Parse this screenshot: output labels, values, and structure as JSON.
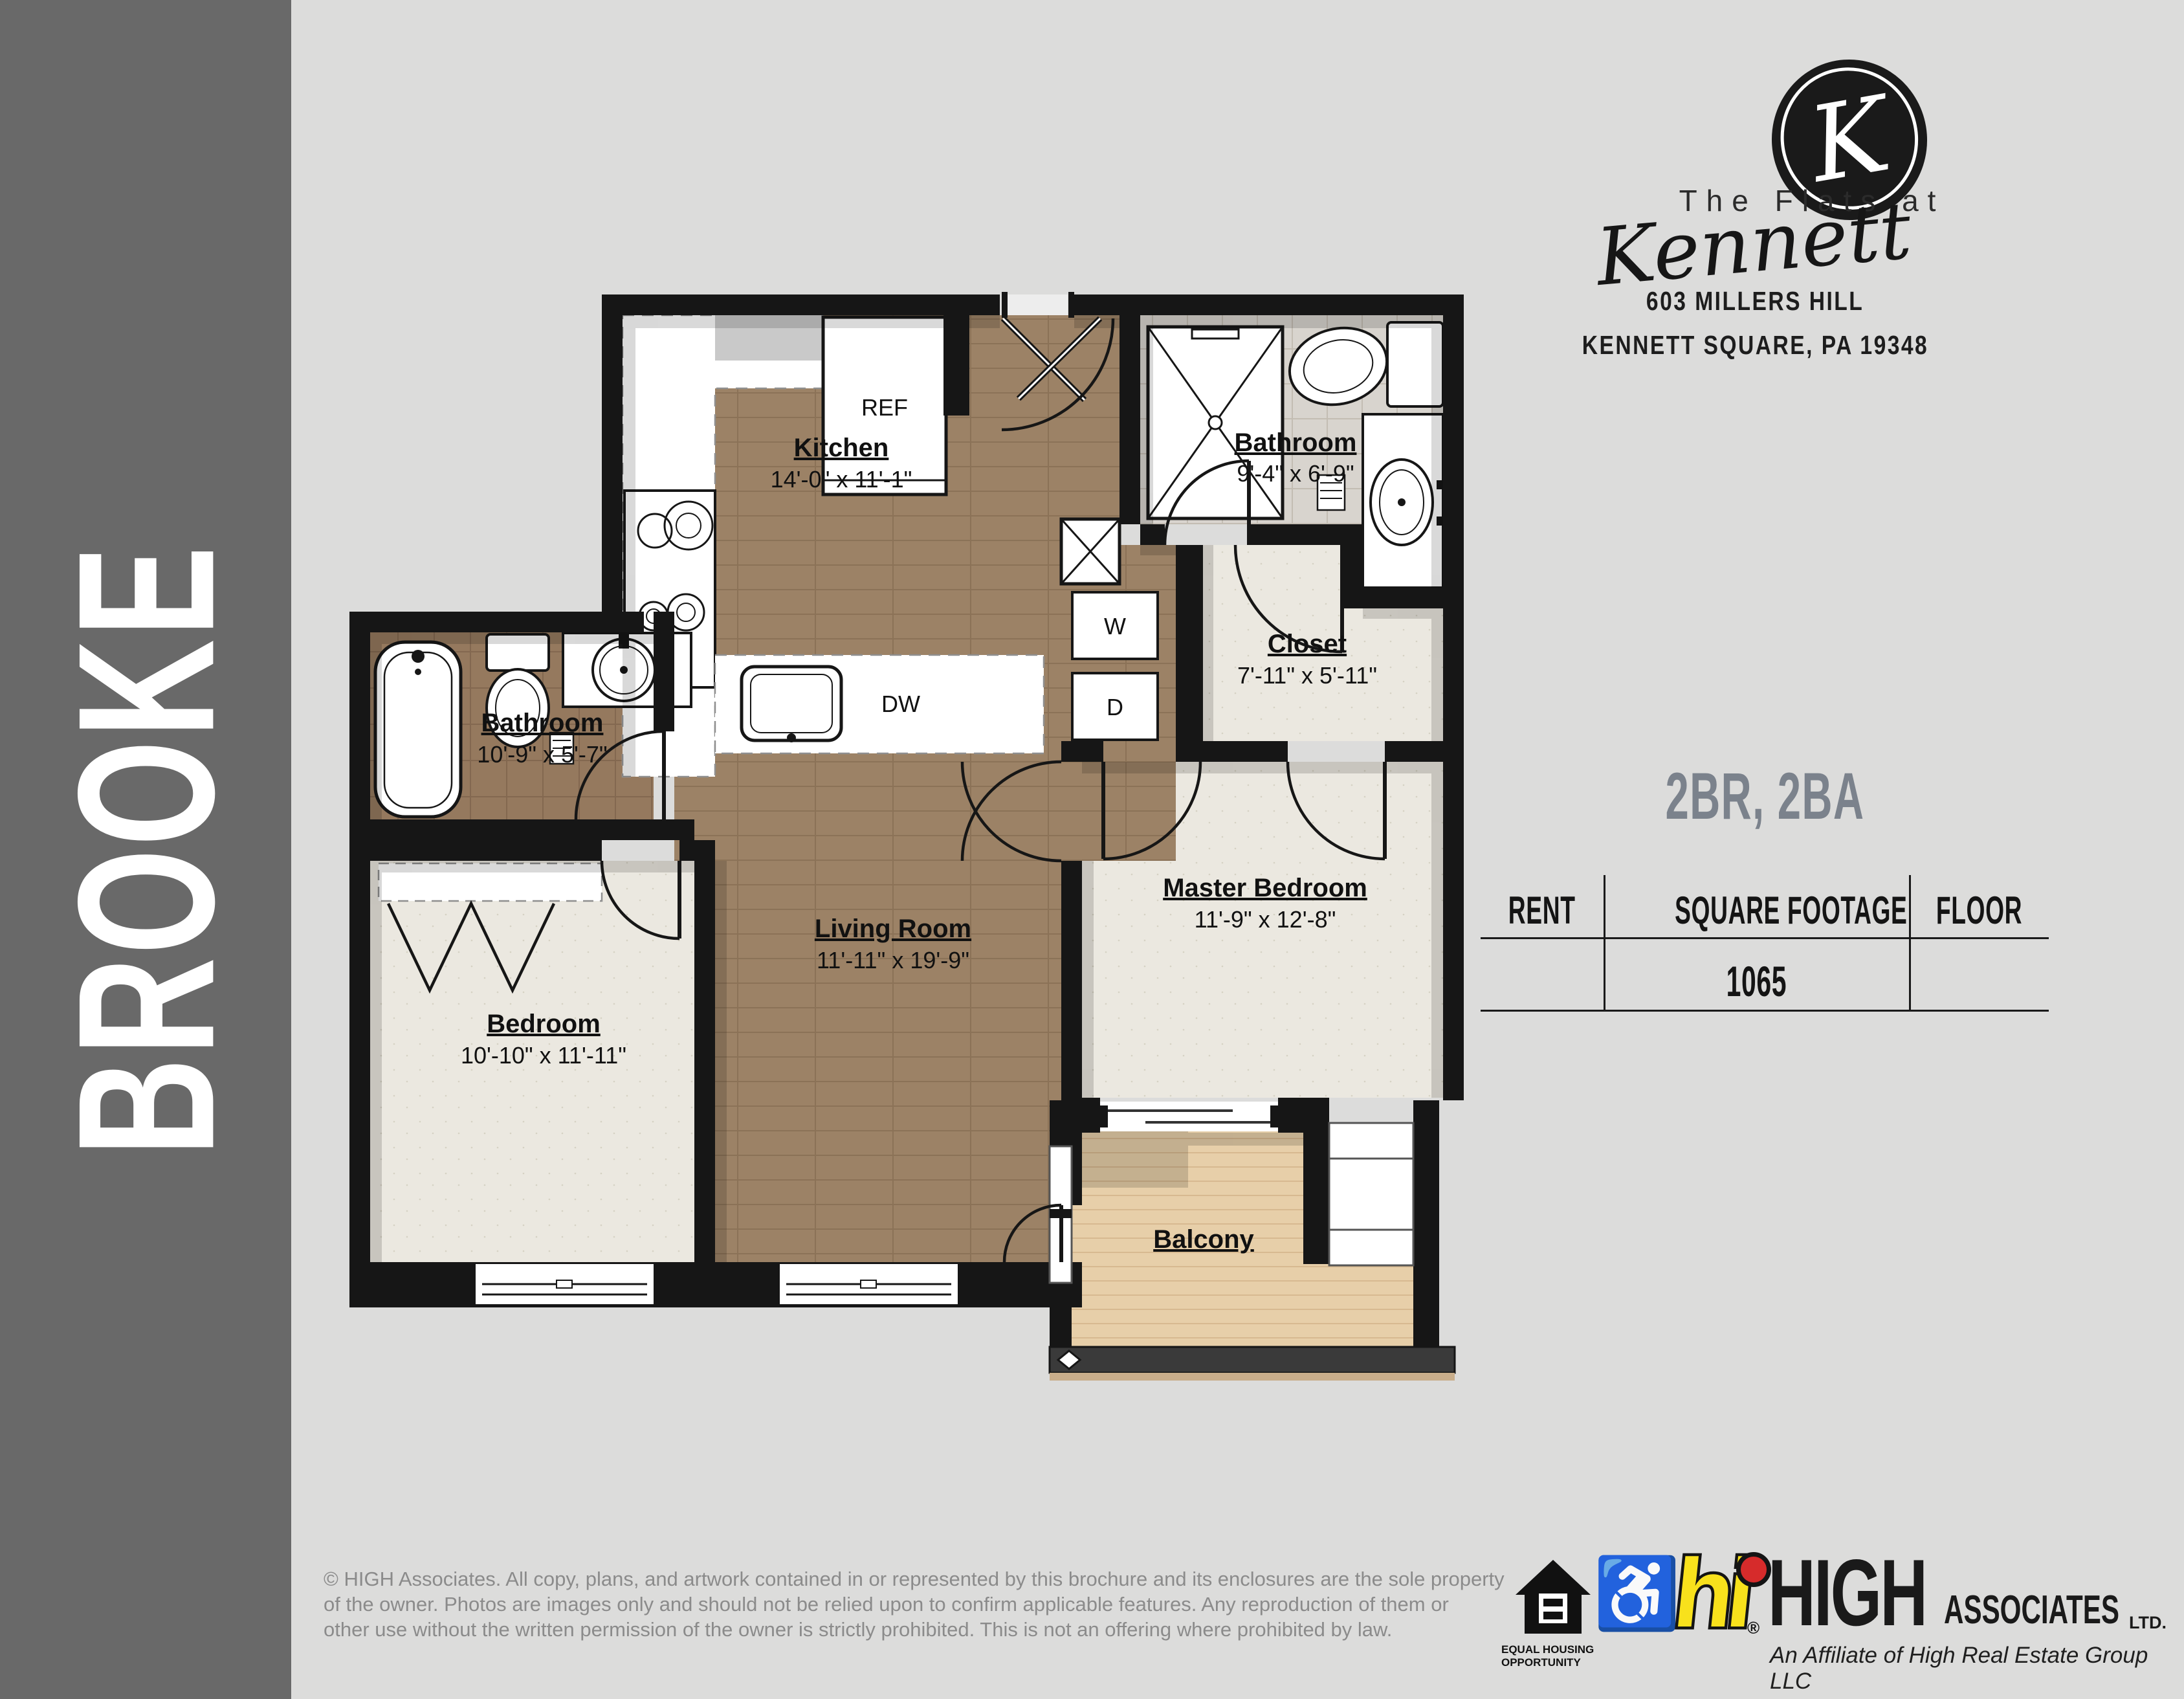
{
  "sidebar": {
    "label": "BROOKE"
  },
  "brand": {
    "monogram": "K",
    "line1": "The Flats at",
    "script": "Kennett",
    "address1": "603 MILLERS HILL",
    "address2": "KENNETT SQUARE, PA 19348"
  },
  "unit": {
    "title": "2BR, 2BA",
    "title_color": "#7b828c",
    "table": {
      "headers": [
        "RENT",
        "SQUARE FOOTAGE",
        "FLOOR"
      ],
      "rent": "",
      "square_footage": "1065",
      "floor": ""
    }
  },
  "floorplan": {
    "rooms": {
      "kitchen": {
        "name": "Kitchen",
        "dims": "14'-0\" x 11'-1\""
      },
      "bath2": {
        "name": "Bathroom",
        "dims": "9'-4\" x 6'-9\""
      },
      "closet": {
        "name": "Closet",
        "dims": "7'-11\" x 5'-11\""
      },
      "bath1": {
        "name": "Bathroom",
        "dims": "10'-9\" x 5'-7\""
      },
      "bedroom": {
        "name": "Bedroom",
        "dims": "10'-10\" x 11'-11\""
      },
      "living": {
        "name": "Living Room",
        "dims": "11'-11\" x 19'-9\""
      },
      "master": {
        "name": "Master Bedroom",
        "dims": "11'-9\" x 12'-8\""
      },
      "balcony": {
        "name": "Balcony",
        "dims": ""
      }
    },
    "appliances": {
      "ref": "REF",
      "dw": "DW",
      "washer": "W",
      "dryer": "D"
    }
  },
  "footer": {
    "copyright": "© HIGH Associates. All copy, plans, and artwork contained in or represented by this brochure and its enclosures are the sole property\nof the owner. Photos are images only and should not be relied upon to confirm applicable features. Any reproduction of them or\nother use without the written permission of the owner is strictly prohibited. This is not an offering where prohibited by law.",
    "eho_line1": "EQUAL HOUSING",
    "eho_line2": "OPPORTUNITY",
    "high_mark": "hi",
    "high_reg": "®",
    "high_name": "HIGH",
    "high_suffix": "ASSOCIATES",
    "high_ltd": "LTD.",
    "high_tagline": "An Affiliate of High Real Estate Group LLC"
  }
}
